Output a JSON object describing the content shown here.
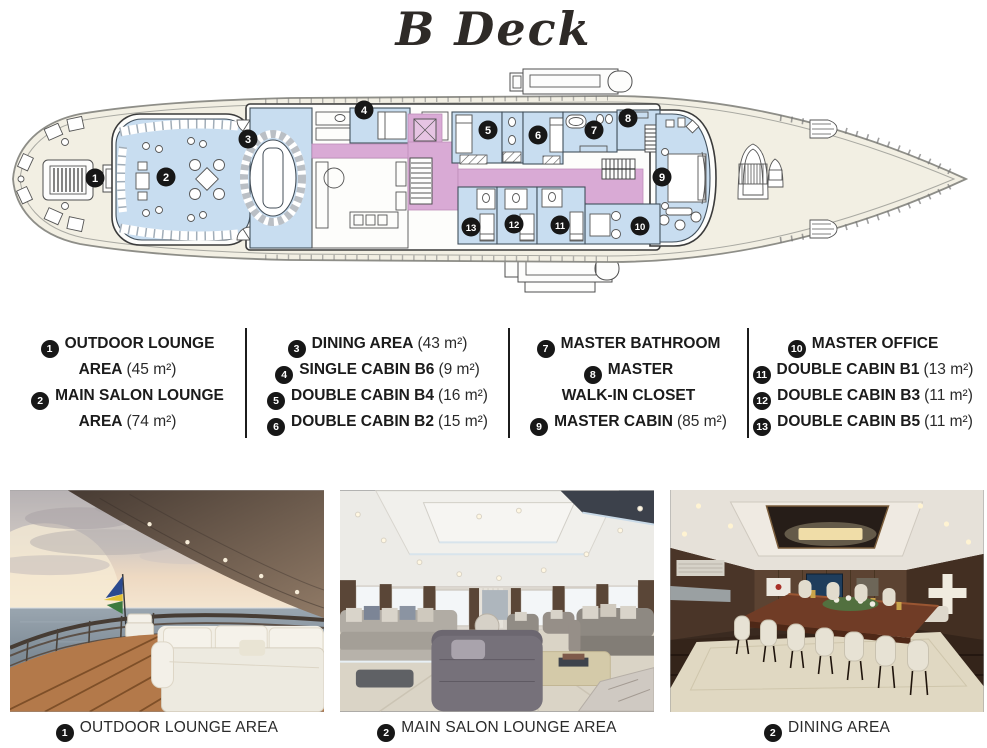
{
  "title": "B Deck",
  "deck_plan": {
    "marker_color": "#171717",
    "colors": {
      "deck": "#f2efe3",
      "room_blue": "#c8ddf0",
      "corridor_pink": "#d9aad5",
      "hull_outline": "#8e8e88",
      "wall": "#3b3b3b"
    },
    "markers": [
      {
        "n": "1",
        "x": 85,
        "y": 116
      },
      {
        "n": "2",
        "x": 156,
        "y": 115
      },
      {
        "n": "3",
        "x": 238,
        "y": 77
      },
      {
        "n": "4",
        "x": 354,
        "y": 48
      },
      {
        "n": "5",
        "x": 478,
        "y": 68
      },
      {
        "n": "6",
        "x": 528,
        "y": 73
      },
      {
        "n": "7",
        "x": 584,
        "y": 68
      },
      {
        "n": "8",
        "x": 618,
        "y": 56
      },
      {
        "n": "9",
        "x": 652,
        "y": 115
      },
      {
        "n": "10",
        "x": 630,
        "y": 164
      },
      {
        "n": "11",
        "x": 550,
        "y": 163
      },
      {
        "n": "12",
        "x": 504,
        "y": 162
      },
      {
        "n": "13",
        "x": 461,
        "y": 165
      }
    ]
  },
  "legend": {
    "col1": {
      "rows": [
        {
          "num": "1",
          "label": "OUTDOOR LOUNGE"
        },
        {
          "label": "AREA",
          "area": "(45 m²)"
        },
        {
          "num": "2",
          "label": "MAIN SALON LOUNGE"
        },
        {
          "label": "AREA",
          "area": "(74 m²)"
        }
      ]
    },
    "col2": {
      "rows": [
        {
          "num": "3",
          "label": "DINING AREA",
          "area": "(43 m²)"
        },
        {
          "num": "4",
          "label": "SINGLE CABIN B6",
          "area": "(9 m²)"
        },
        {
          "num": "5",
          "label": "DOUBLE CABIN B4",
          "area": "(16 m²)"
        },
        {
          "num": "6",
          "label": "DOUBLE CABIN B2",
          "area": "(15 m²)"
        }
      ]
    },
    "col3": {
      "rows": [
        {
          "num": "7",
          "label": "MASTER BATHROOM"
        },
        {
          "num": "8",
          "label": "MASTER"
        },
        {
          "label": "WALK-IN CLOSET"
        },
        {
          "num": "9",
          "label": "MASTER CABIN",
          "area": "(85 m²)"
        }
      ]
    },
    "col4": {
      "rows": [
        {
          "num": "10",
          "label": "MASTER OFFICE"
        },
        {
          "num": "11",
          "label": "DOUBLE CABIN B1",
          "area": "(13 m²)"
        },
        {
          "num": "12",
          "label": "DOUBLE CABIN B3",
          "area": "(11 m²)"
        },
        {
          "num": "13",
          "label": "DOUBLE CABIN B5",
          "area": "(11 m²)"
        }
      ]
    }
  },
  "photos": {
    "items": [
      {
        "num": "1",
        "caption": "OUTDOOR LOUNGE AREA"
      },
      {
        "num": "2",
        "caption": "MAIN SALON LOUNGE AREA"
      },
      {
        "num": "2",
        "caption": "DINING AREA"
      }
    ]
  }
}
